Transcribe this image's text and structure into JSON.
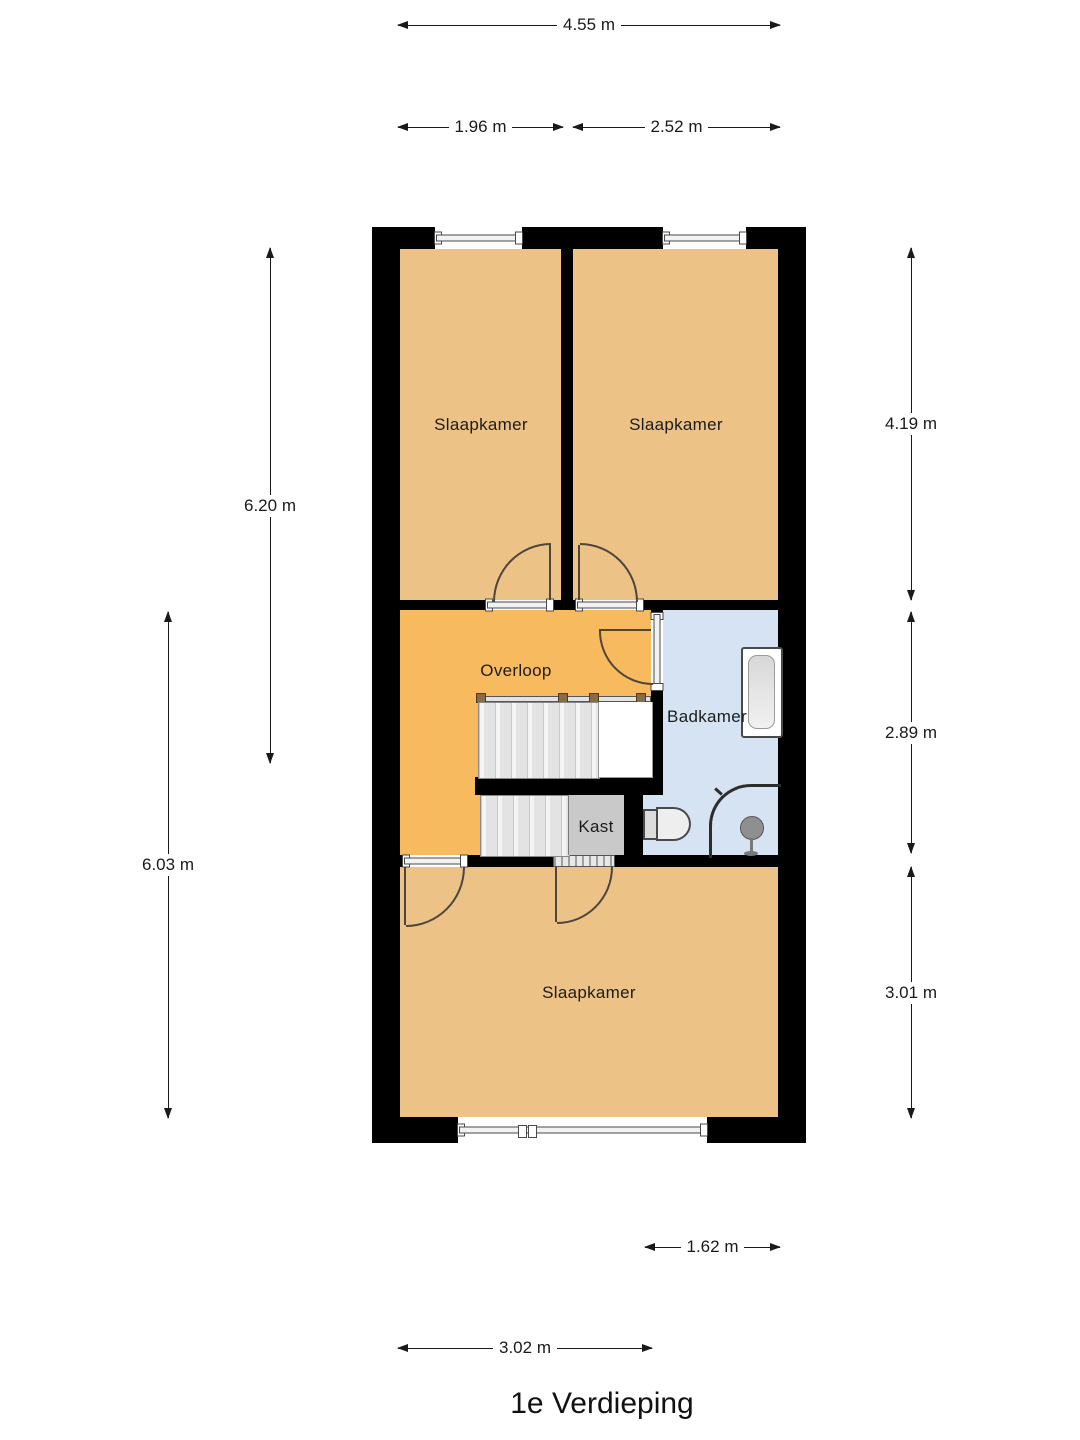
{
  "title": "1e Verdieping",
  "colors": {
    "wall": "#000000",
    "bedroom_fill": "#ecc287",
    "landing_fill": "#f8ba5e",
    "bathroom_fill": "#d6e3f3",
    "closet_fill": "#c9c9c9"
  },
  "rooms": [
    {
      "label": "Slaapkamer"
    },
    {
      "label": "Slaapkamer"
    },
    {
      "label": "Overloop"
    },
    {
      "label": "Badkamer"
    },
    {
      "label": "Kast"
    },
    {
      "label": "Slaapkamer"
    }
  ],
  "fixtures": [
    "staircase",
    "bathtub",
    "toilet",
    "shower"
  ],
  "dimensions": {
    "top_total": "4.55 m",
    "top_left_room": "1.96 m",
    "top_right_room": "2.52 m",
    "left_upper": "6.20 m",
    "left_lower": "6.03 m",
    "right_top": "4.19 m",
    "right_middle": "2.89 m",
    "right_bottom": "3.01 m",
    "bottom_bathroom": "1.62 m",
    "bottom_room": "3.02 m"
  }
}
